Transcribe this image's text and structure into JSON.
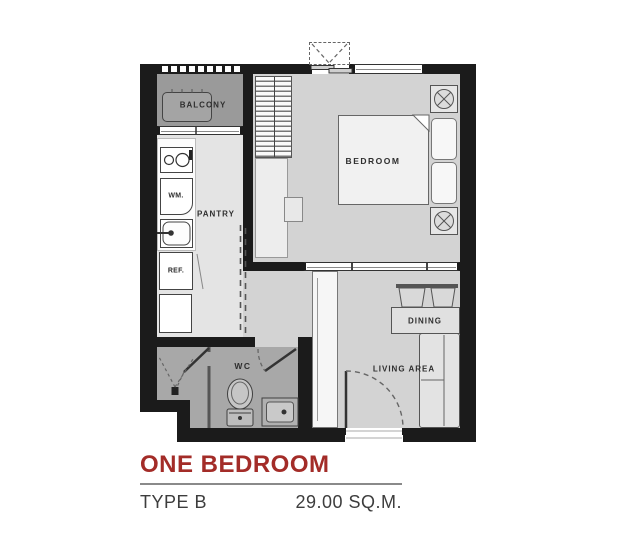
{
  "plan": {
    "labels": {
      "balcony": "BALCONY",
      "pantry": "PANTRY",
      "bedroom": "BEDROOM",
      "wc": "WC",
      "dining": "DINING",
      "living_area": "LIVING AREA",
      "washing_machine": "WM.",
      "refrigerator": "REF."
    }
  },
  "legend": {
    "title": "ONE BEDROOM",
    "type": "TYPE B",
    "area": "29.00 SQ.M."
  },
  "colors": {
    "wall": "#1b1b1b",
    "accent": "#A32C28",
    "floor_room": "#d3d3d3",
    "floor_pantry": "#e4e4e4",
    "floor_wc": "#a8a8a8",
    "floor_balcony": "#9a9a9a",
    "label": "#2e2e2e",
    "legend": "#3d3d3d"
  }
}
